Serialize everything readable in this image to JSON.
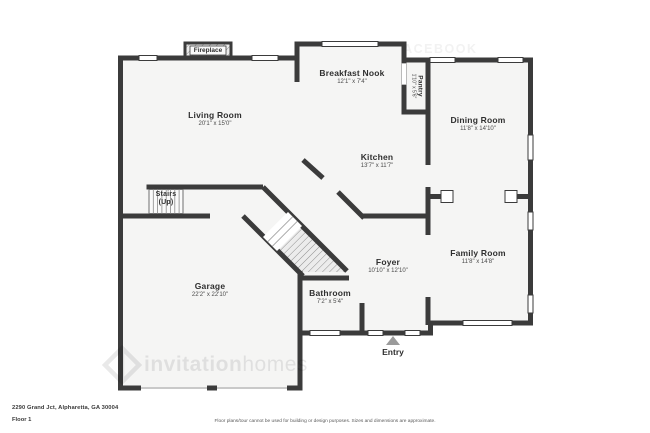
{
  "plan": {
    "rooms": {
      "living": {
        "name": "Living Room",
        "dims": "20'1\" x 15'0\""
      },
      "nook": {
        "name": "Breakfast Nook",
        "dims": "12'1\" x 7'4\""
      },
      "pantry": {
        "name": "Pantry",
        "dims": "1'10\" x 5'6\""
      },
      "dining": {
        "name": "Dining Room",
        "dims": "11'8\" x 14'10\""
      },
      "kitchen": {
        "name": "Kitchen",
        "dims": "13'7\" x 11'7\""
      },
      "stairs": {
        "line1": "Stairs",
        "line2": "(Up)"
      },
      "garage": {
        "name": "Garage",
        "dims": "22'2\" x 22'10\""
      },
      "foyer": {
        "name": "Foyer",
        "dims": "10'10\" x 12'10\""
      },
      "bathroom": {
        "name": "Bathroom",
        "dims": "7'2\" x 5'4\""
      },
      "family": {
        "name": "Family Room",
        "dims": "11'8\" x 14'8\""
      },
      "fireplace": {
        "name": "Fireplace"
      },
      "entry": {
        "name": "Entry"
      }
    },
    "colors": {
      "wall": "#3b3b3b",
      "floor_fill": "#f5f5f4",
      "entry_arrow": "#9b9b9b"
    }
  },
  "watermark": {
    "top_line1": "FIND US ON FACEBOOK",
    "top_line2": "INVITATION HOMES",
    "bottom_bold": "invitation",
    "bottom_light": "homes"
  },
  "footer": {
    "address": "2290 Grand Jct, Alpharetta, GA 30004",
    "floor_label": "Floor 1",
    "disclaimer": "Floor plans/tour cannot be used for building or design purposes. Sizes and dimensions are approximate."
  }
}
